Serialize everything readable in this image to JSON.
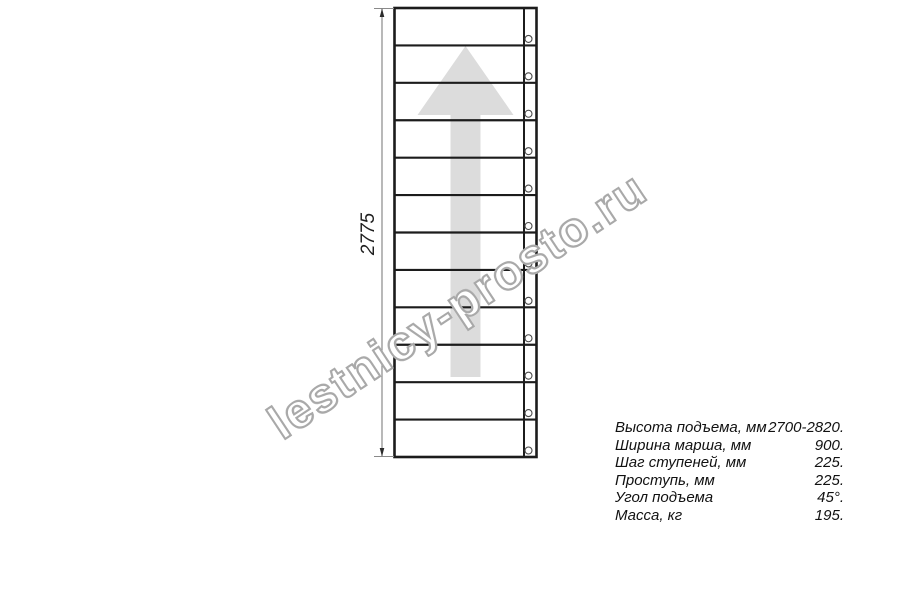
{
  "diagram": {
    "dimension_label": "2775",
    "step_count": 12,
    "colors": {
      "line": "#1c1c1c",
      "arrow_fill": "#dcdcdc",
      "dim_line": "#8a8a8a",
      "dim_arrow": "#2b2b2b",
      "screw_stroke": "#4a4a4a",
      "screw_fill": "#ffffff"
    }
  },
  "watermark": {
    "text": "lestnicy-prosto.ru",
    "outline_color": "#a9a9a9"
  },
  "spec_table": {
    "rows": [
      {
        "label": "Высота подъема, мм",
        "value": "2700-2820."
      },
      {
        "label": "Ширина марша, мм",
        "value": "900."
      },
      {
        "label": "Шаг ступеней, мм",
        "value": "225."
      },
      {
        "label": "Проступь, мм",
        "value": "225."
      },
      {
        "label": "Угол подъема",
        "value": "45°."
      },
      {
        "label": "Масса, кг",
        "value": "195."
      }
    ]
  }
}
